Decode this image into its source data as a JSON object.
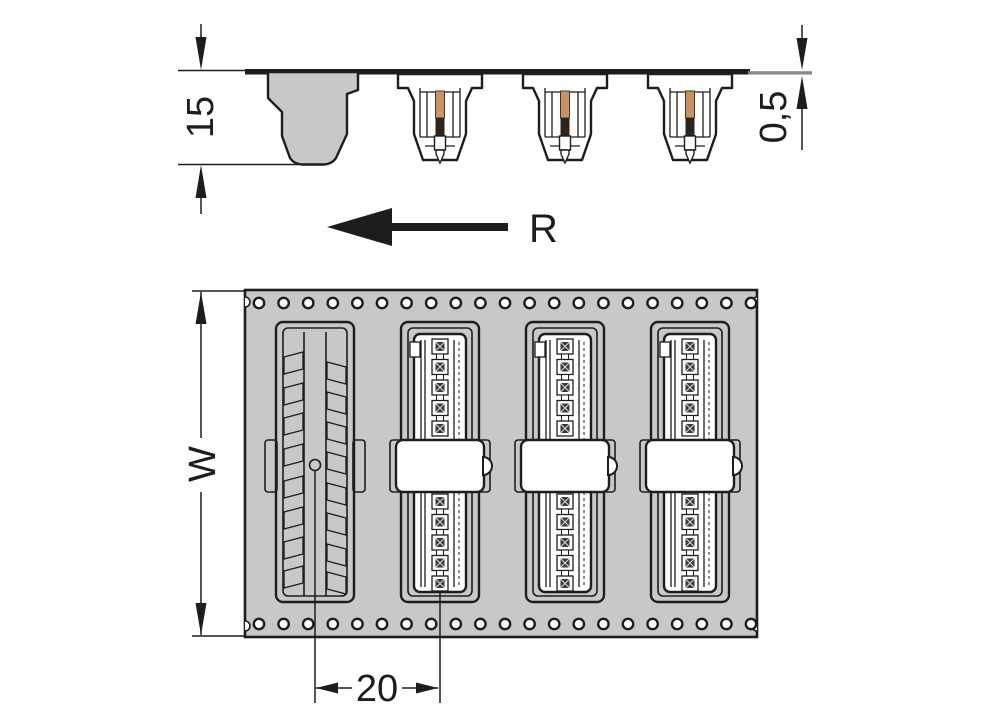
{
  "labels": {
    "pocket_depth": "15",
    "tape_thickness": "0,5",
    "unwind_direction": "R",
    "tape_width": "W",
    "pocket_pitch": "20"
  },
  "colors": {
    "outline": "#1d1d1d",
    "tape_gray": "#c8c8c8",
    "pin_copper": "#c49468",
    "pin_dark": "#2e231b",
    "break_line_gray": "#8a8a8a",
    "background": "#ffffff"
  },
  "structure": {
    "sprocket_holes_per_row": 21,
    "pockets_total": 4,
    "empty_pockets": 1,
    "loaded_pockets": 3,
    "contacts_visible_per_connector": 10,
    "teeth_per_side_empty_pocket": 8
  }
}
